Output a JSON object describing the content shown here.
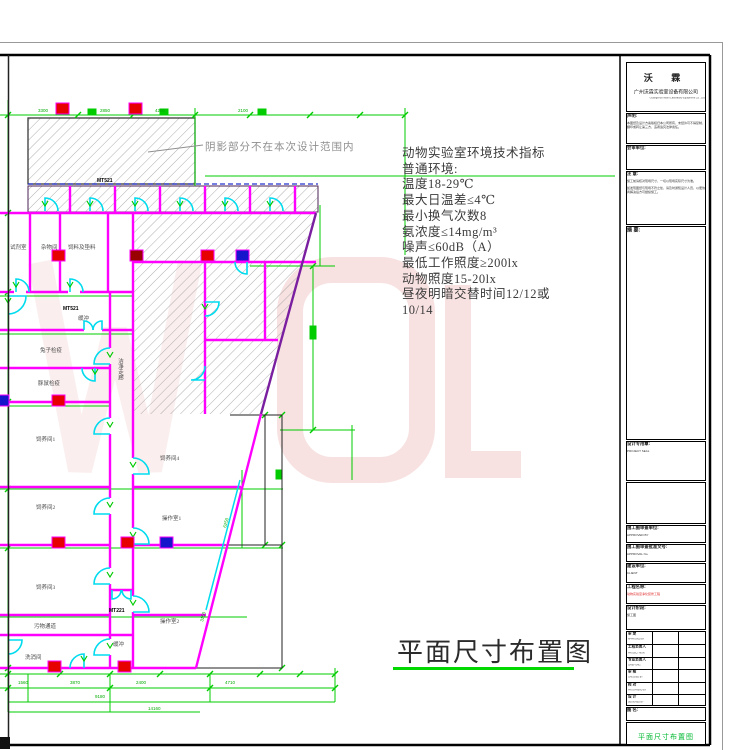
{
  "note": "阴影部分不在本次设计范围内",
  "main_title": {
    "text": "平面尺寸布置图"
  },
  "watermark": {
    "letters": "WOL",
    "color": "#f3c9c9"
  },
  "specs": {
    "lines": [
      "动物实验室环境技术指标",
      "普通环境:",
      "温度18-29℃",
      "最大日温差≤4℃",
      "最小换气次数8",
      "氨浓度≤14mg/m³",
      "噪声≤60dB（A）",
      "最低工作照度≥200lx",
      "动物照度15-20lx",
      "昼夜明暗交替时间12/12或",
      "10/14"
    ]
  },
  "plan": {
    "room_labels": [
      {
        "t": "试剂室",
        "x": 10,
        "y": 249
      },
      {
        "t": "杂物间",
        "x": 41,
        "y": 249
      },
      {
        "t": "饲料及垫料",
        "x": 68,
        "y": 249
      },
      {
        "t": "缓冲",
        "x": 78,
        "y": 320
      },
      {
        "t": "兔子检疫",
        "x": 40,
        "y": 352
      },
      {
        "t": "豚鼠检疫",
        "x": 38,
        "y": 385
      },
      {
        "t": "饲养间1",
        "x": 36,
        "y": 441
      },
      {
        "t": "饲养间2",
        "x": 36,
        "y": 509
      },
      {
        "t": "饲养间3",
        "x": 36,
        "y": 589
      },
      {
        "t": "污物通道",
        "x": 34,
        "y": 628
      },
      {
        "t": "洗消间",
        "x": 25,
        "y": 659
      },
      {
        "t": "饲养间4",
        "x": 160,
        "y": 460
      },
      {
        "t": "操作室1",
        "x": 162,
        "y": 520
      },
      {
        "t": "操作室2",
        "x": 160,
        "y": 623
      },
      {
        "t": "缓冲",
        "x": 113,
        "y": 646
      }
    ],
    "vertical_labels": [
      {
        "t": "洁净走廊",
        "x": 120,
        "y": 358
      }
    ],
    "code_labels": [
      {
        "t": "MT521",
        "x": 97,
        "y": 182
      },
      {
        "t": "MT521",
        "x": 63,
        "y": 310
      },
      {
        "t": "MT221",
        "x": 109,
        "y": 612
      }
    ],
    "dim_labels": [
      {
        "t": "3300",
        "x": 38,
        "y": 112
      },
      {
        "t": "2850",
        "x": 100,
        "y": 112
      },
      {
        "t": "4200",
        "x": 155,
        "y": 112
      },
      {
        "t": "2100",
        "x": 238,
        "y": 112
      },
      {
        "t": "1560",
        "x": 18,
        "y": 684
      },
      {
        "t": "3870",
        "x": 70,
        "y": 684
      },
      {
        "t": "2400",
        "x": 136,
        "y": 684
      },
      {
        "t": "4710",
        "x": 225,
        "y": 684
      },
      {
        "t": "9180",
        "x": 95,
        "y": 698
      },
      {
        "t": "14160",
        "x": 148,
        "y": 710
      }
    ],
    "rot_dim_labels": [
      {
        "t": "6250",
        "x": 226,
        "y": 528,
        "r": -75
      },
      {
        "t": "3150",
        "x": 203,
        "y": 622,
        "r": -75
      }
    ],
    "markers": [
      {
        "x": 56,
        "y": 103,
        "c": "#e60000"
      },
      {
        "x": 129,
        "y": 103,
        "c": "#e60000"
      },
      {
        "x": 52,
        "y": 250,
        "c": "#e60000"
      },
      {
        "x": 130,
        "y": 250,
        "c": "#990000"
      },
      {
        "x": 201,
        "y": 250,
        "c": "#e60000"
      },
      {
        "x": 236,
        "y": 250,
        "c": "#1515cc"
      },
      {
        "x": -4,
        "y": 395,
        "c": "#1515cc"
      },
      {
        "x": 52,
        "y": 395,
        "c": "#e60000"
      },
      {
        "x": 52,
        "y": 537,
        "c": "#e60000"
      },
      {
        "x": 121,
        "y": 537,
        "c": "#e60000"
      },
      {
        "x": 160,
        "y": 537,
        "c": "#1515cc"
      },
      {
        "x": 48,
        "y": 661,
        "c": "#e60000"
      },
      {
        "x": 118,
        "y": 661,
        "c": "#e60000"
      }
    ]
  },
  "titleblock": {
    "company": {
      "name": "沃 霖",
      "full": "广州沃霖实验室设备有限公司",
      "en": "Guangzhou Wolin Laboratory Equipment Co., Ltd"
    },
    "statement": {
      "label": "声明:",
      "text": "本图纸及设计方案版权归本公司所有，未经许可不得复制、翻印或转让第三方，违者追究法律责任。"
    },
    "joint_review": {
      "label": "会审单位:"
    },
    "notice": {
      "label": "注 意:",
      "text1": "施工前请核对现场尺寸，一切以现场实际尺寸为准。",
      "text2": "如发现图纸与现场不符之处，请及时通知设计人员，以便协商解决后方可继续施工。"
    },
    "abstract": {
      "label": "摘 要:"
    },
    "seal": {
      "label": "设计专用章:",
      "en": "PROJECT SEAL"
    },
    "review_unit": {
      "label": "施工图审查单位:",
      "en": "APPROVED BY"
    },
    "approval_no": {
      "label": "施工图审查批准文号:",
      "en": "APPROVAL No."
    },
    "client": {
      "label": "建设单位:",
      "en": "CLIENT"
    },
    "project": {
      "label": "工程名称:",
      "en": "PROJECT",
      "value": "动物实验室净化装修工程"
    },
    "stage": {
      "label": "设计阶段:",
      "value": "施工图"
    },
    "sign_rows": [
      {
        "cn": "审 定",
        "en": "APPROVED BY"
      },
      {
        "cn": "工程负责人",
        "en": "PROJECT MGR."
      },
      {
        "cn": "专业负责人",
        "en": "CHIEF ENG."
      },
      {
        "cn": "审 核",
        "en": "CHECKED BY"
      },
      {
        "cn": "校 对",
        "en": "PROOFREAD BY"
      },
      {
        "cn": "设 计",
        "en": "DESIGNED BY"
      }
    ],
    "drawing": {
      "label": "图 名:",
      "en": "DRAWING",
      "value": "平面尺寸布置图"
    }
  }
}
